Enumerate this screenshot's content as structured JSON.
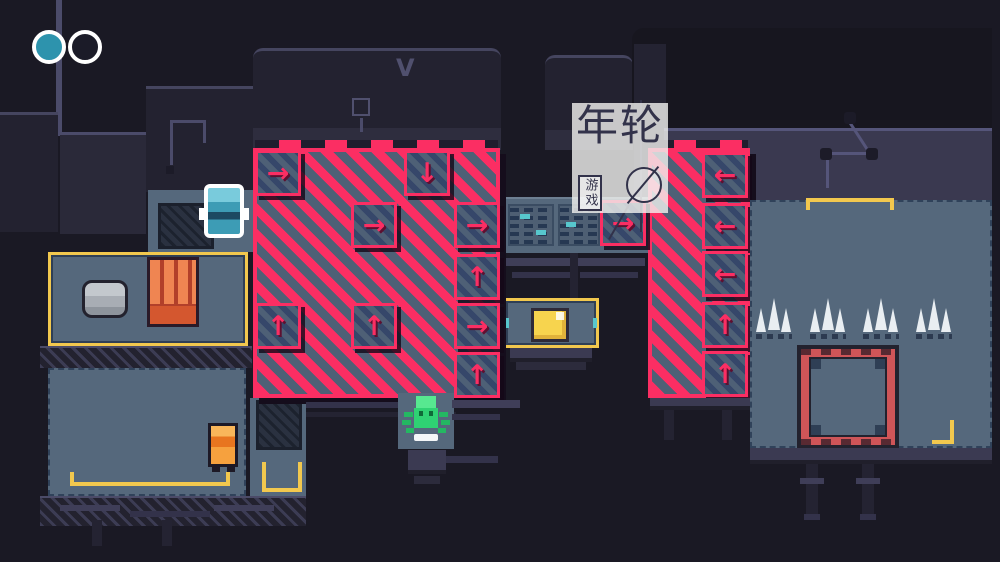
{
  "scene": {
    "description": "top-down pixel-art puzzle room with conveyor hazard zones"
  },
  "hud": {
    "orbs": [
      {
        "state": "filled"
      },
      {
        "state": "empty"
      }
    ]
  },
  "watermark": {
    "logo_text": "年轮",
    "badge_text": "游戏"
  },
  "palette": {
    "background": "#1a1924",
    "floor": "#55687c",
    "hazard_pink": "#fb2e63",
    "hazard_stripe_gray": "#4e6076",
    "tile_stripe_dark": "#36476a",
    "yellow_border": "#f2c84e",
    "wall_dark": "#232230",
    "wall_navy": "#3a3950",
    "teal_accent": "#57c7cd",
    "red_frame": "#cf5558",
    "player_teal": "#79cbdc",
    "npc_green": "#2fd273",
    "npc_orange": "#f6a13e",
    "spike_white": "#e9eef2"
  },
  "zones": {
    "center": {
      "name": "center hazard zone",
      "tiles": [
        {
          "dir": "right",
          "glyph": "→"
        },
        {
          "dir": "down",
          "glyph": "↓"
        },
        {
          "dir": "right",
          "glyph": "→"
        },
        {
          "dir": "right",
          "glyph": "→"
        },
        {
          "dir": "up",
          "glyph": "↑"
        },
        {
          "dir": "up",
          "glyph": "↑"
        },
        {
          "dir": "up",
          "glyph": "↑"
        },
        {
          "dir": "right",
          "glyph": "→"
        },
        {
          "dir": "up",
          "glyph": "↑"
        }
      ]
    },
    "bridge": {
      "tiles": [
        {
          "dir": "right",
          "glyph": "→"
        }
      ]
    },
    "right": {
      "name": "right hazard zone",
      "tiles": [
        {
          "dir": "left",
          "glyph": "←"
        },
        {
          "dir": "left",
          "glyph": "←"
        },
        {
          "dir": "left",
          "glyph": "←"
        },
        {
          "dir": "up",
          "glyph": "↑"
        },
        {
          "dir": "up",
          "glyph": "↑"
        }
      ]
    }
  },
  "decor": {
    "vent_emblem": "V"
  },
  "characters": [
    {
      "id": "player",
      "desc": "teal robot with white outline"
    },
    {
      "id": "green-creature",
      "desc": "green critter on pedestal"
    },
    {
      "id": "orange-robot",
      "desc": "small orange robot"
    }
  ]
}
